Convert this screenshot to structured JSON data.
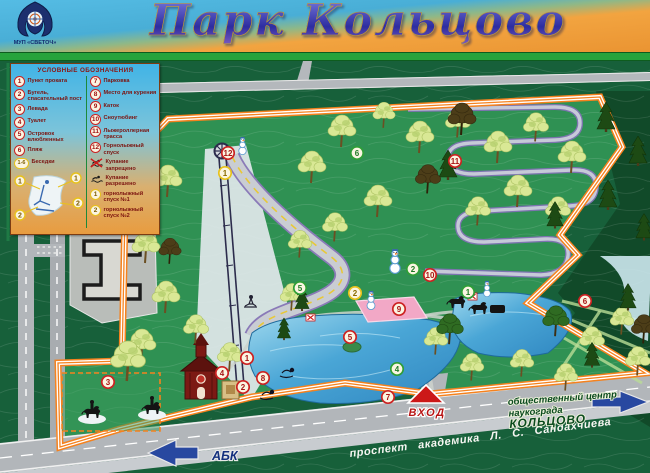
{
  "header": {
    "title": "Парк Кольцово",
    "logo_caption": "МУП «СВЕТОЧ»"
  },
  "legend": {
    "title": "УСЛОВНЫЕ ОБОЗНАЧЕНИЯ",
    "left_items": [
      {
        "marker": "1",
        "type": "red",
        "label": "Пункт проката"
      },
      {
        "marker": "2",
        "type": "red",
        "label": "Бугель, спасательный пост"
      },
      {
        "marker": "3",
        "type": "red",
        "label": "Левада"
      },
      {
        "marker": "4",
        "type": "red",
        "label": "Туалет"
      },
      {
        "marker": "5",
        "type": "red",
        "label": "Островок влюбленных"
      },
      {
        "marker": "6",
        "type": "red",
        "label": "Пляж"
      },
      {
        "marker": "1-6",
        "type": "yellow-range",
        "label": "Беседки"
      }
    ],
    "right_items": [
      {
        "marker": "7",
        "type": "red",
        "label": "Парковка"
      },
      {
        "marker": "8",
        "type": "red",
        "label": "Место для курения"
      },
      {
        "marker": "9",
        "type": "red",
        "label": "Каток"
      },
      {
        "marker": "10",
        "type": "red",
        "label": "Сноутюбинг"
      },
      {
        "marker": "11",
        "type": "red",
        "label": "Лыжероллерная трасса"
      },
      {
        "marker": "12",
        "type": "red",
        "label": "Горнолыжный спуск"
      },
      {
        "marker": "",
        "type": "noswim",
        "label": "Купание запрещено"
      },
      {
        "marker": "",
        "type": "swim",
        "label": "Купание разрешено"
      },
      {
        "marker": "1",
        "type": "yellow",
        "label": "горнолыжный спуск №1"
      },
      {
        "marker": "2",
        "type": "yellow",
        "label": "горнолыжный спуск №2"
      }
    ],
    "slope_labels": [
      "1",
      "2"
    ]
  },
  "map": {
    "entrance_label": "ВХОД",
    "abk_label": "АБК",
    "avenue_label": "проспект академика Л. С. Сандахчиева",
    "center_label_lines": [
      "общественный центр",
      "наукограда",
      "КОЛЬЦОВО"
    ],
    "markers": [
      {
        "n": "1",
        "color": "red",
        "x": 247,
        "y": 297
      },
      {
        "n": "2",
        "color": "red",
        "x": 243,
        "y": 326
      },
      {
        "n": "3",
        "color": "red",
        "x": 108,
        "y": 321
      },
      {
        "n": "4",
        "color": "red",
        "x": 222,
        "y": 312
      },
      {
        "n": "5",
        "color": "red",
        "x": 350,
        "y": 276
      },
      {
        "n": "6",
        "color": "red",
        "x": 585,
        "y": 240
      },
      {
        "n": "7",
        "color": "red",
        "x": 388,
        "y": 336
      },
      {
        "n": "8",
        "color": "red",
        "x": 263,
        "y": 317
      },
      {
        "n": "9",
        "color": "red",
        "x": 399,
        "y": 248
      },
      {
        "n": "10",
        "color": "red",
        "x": 430,
        "y": 214
      },
      {
        "n": "11",
        "color": "red",
        "x": 455,
        "y": 100
      },
      {
        "n": "12",
        "color": "red",
        "x": 228,
        "y": 92
      },
      {
        "n": "1",
        "color": "green",
        "x": 468,
        "y": 231
      },
      {
        "n": "2",
        "color": "green",
        "x": 413,
        "y": 208
      },
      {
        "n": "4",
        "color": "green",
        "x": 397,
        "y": 308
      },
      {
        "n": "5",
        "color": "green",
        "x": 300,
        "y": 227
      },
      {
        "n": "6",
        "color": "green",
        "x": 357,
        "y": 92
      },
      {
        "n": "1",
        "color": "yellow",
        "x": 225,
        "y": 112
      },
      {
        "n": "2",
        "color": "yellow",
        "x": 355,
        "y": 232
      }
    ]
  },
  "colors": {
    "boundary_orange": "#f5821e",
    "park_green": "#2f9153",
    "forest_green": "#17603a",
    "pond_blue": "#4aa6d6",
    "rink_pink": "#f2a8c6",
    "marker_red": "#cc2222",
    "marker_green": "#2f9e36",
    "marker_yellow": "#e8c21c",
    "arrow_blue": "#2848a0",
    "entrance_red": "#cc1818"
  }
}
